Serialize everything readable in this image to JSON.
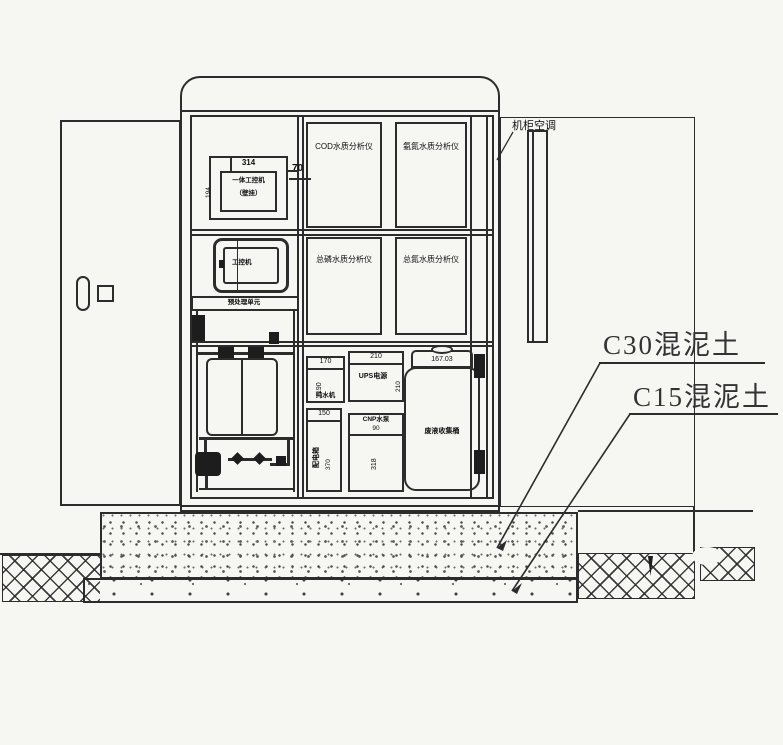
{
  "colors": {
    "line": "#2c2c2c",
    "background": "#f6f6f3"
  },
  "cabinet": {
    "ac_label": "机柜空调",
    "dim_70": "70",
    "instruments": [
      {
        "label": "COD水质分析仪"
      },
      {
        "label": "氨氮水质分析仪"
      },
      {
        "label": "总磷水质分析仪"
      },
      {
        "label": "总氮水质分析仪"
      }
    ],
    "ipc": {
      "dim_top": "314",
      "line1": "一体工控机",
      "line2": "（壁挂）",
      "dim_side": "194"
    },
    "monitor_label": "工控机",
    "shelf_label": "预处理单元",
    "units": {
      "purewater": {
        "dim_top": "170",
        "dim_side": "190",
        "label": "纯水机"
      },
      "ups": {
        "dim_top": "210",
        "label": "UPS电源",
        "dim_side": "210"
      },
      "power": {
        "dim_top": "150",
        "label": "配电箱",
        "dim_side": "370"
      },
      "pump": {
        "label": "CNP水泵",
        "dim": "90",
        "dim_side": "318"
      }
    },
    "barrel": {
      "dim": "167.03",
      "label": "废液收集桶"
    }
  },
  "foundation": {
    "c30_label": "C30混泥土",
    "c15_label": "C15混泥土"
  }
}
